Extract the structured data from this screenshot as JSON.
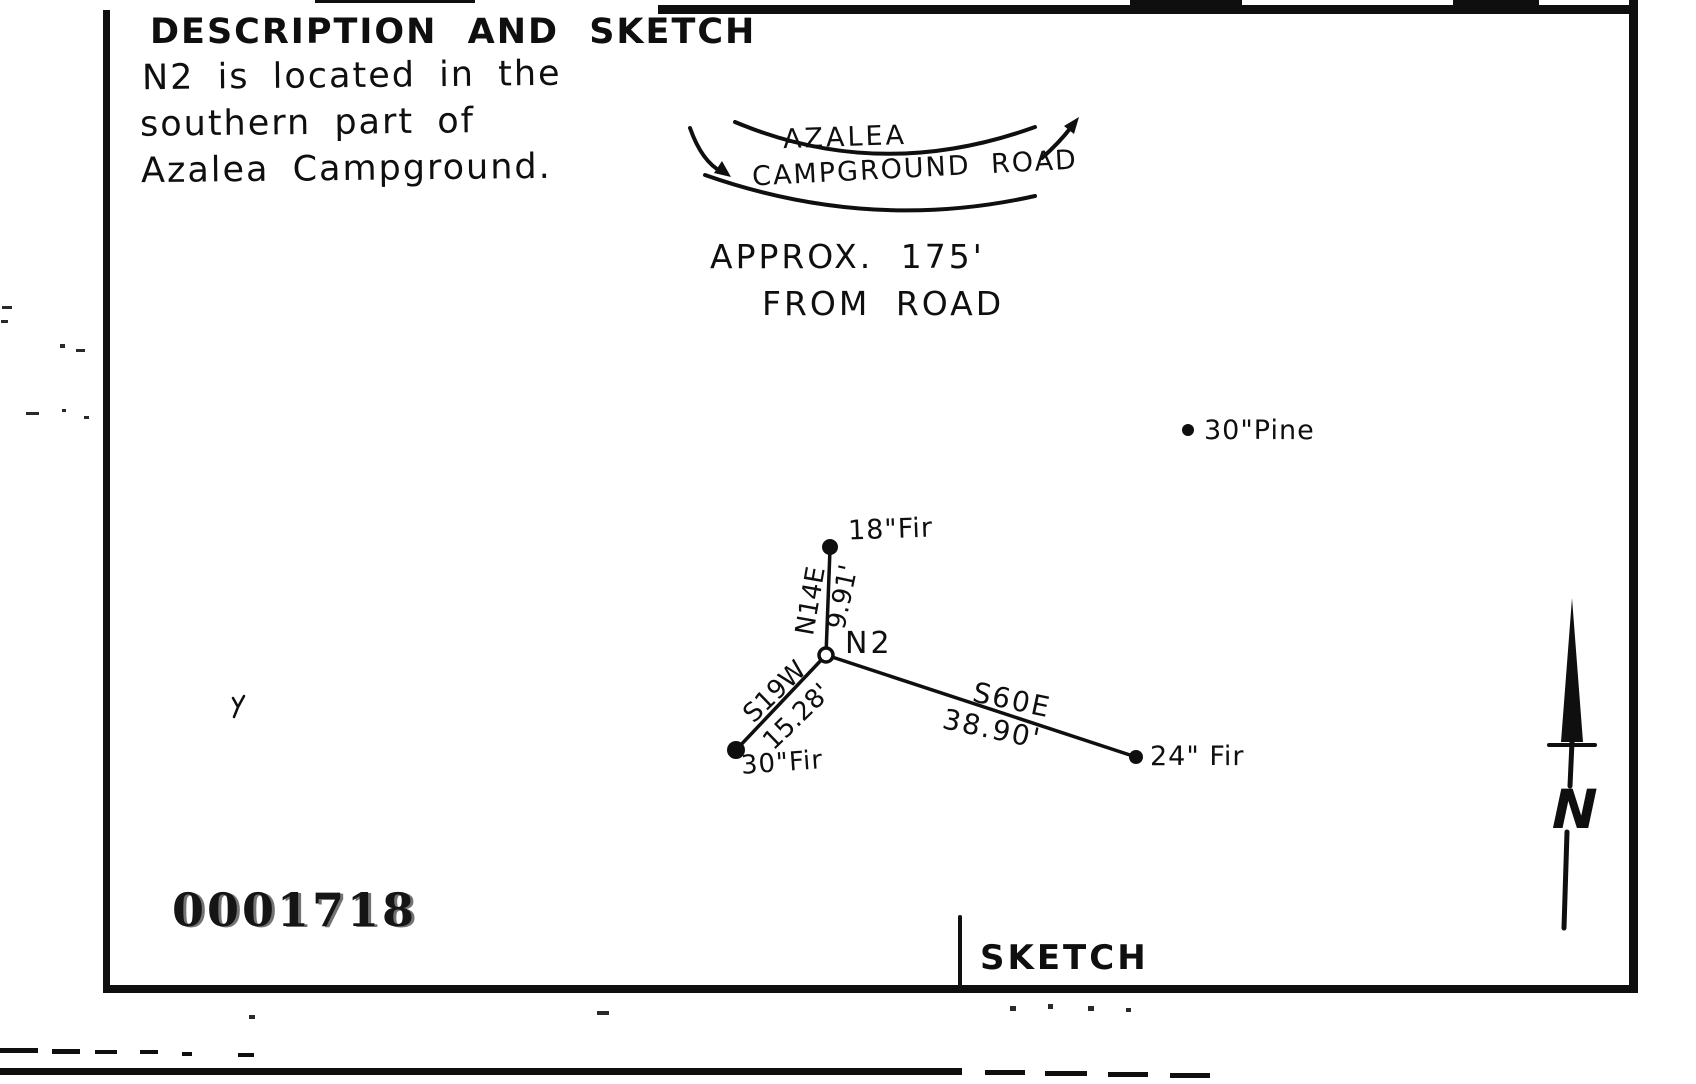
{
  "document": {
    "title": "DESCRIPTION AND SKETCH",
    "description_lines": [
      "N2 is located in the",
      "southern part of",
      "Azalea Campground."
    ],
    "stamp_number": "0001718",
    "footer_label": "SKETCH"
  },
  "sketch": {
    "road": {
      "name_line1": "AZALEA",
      "name_line2": "CAMPGROUND ROAD"
    },
    "approx_note_line1": "APPROX.  175'",
    "approx_note_line2": "FROM ROAD",
    "station_label": "N2",
    "references": [
      {
        "label": "18\"Fir",
        "bearing": "N14E",
        "distance": "9.91'"
      },
      {
        "label": "30\"Fir",
        "bearing": "S19W",
        "distance": "15.28'"
      },
      {
        "label": "24\" Fir",
        "bearing": "S60E",
        "distance": "38.90'"
      }
    ],
    "other_trees": [
      {
        "label": "30\"Pine"
      }
    ],
    "north_arrow_label": "N"
  },
  "colors": {
    "ink": "#0f0f0f",
    "paper": "#ffffff"
  }
}
